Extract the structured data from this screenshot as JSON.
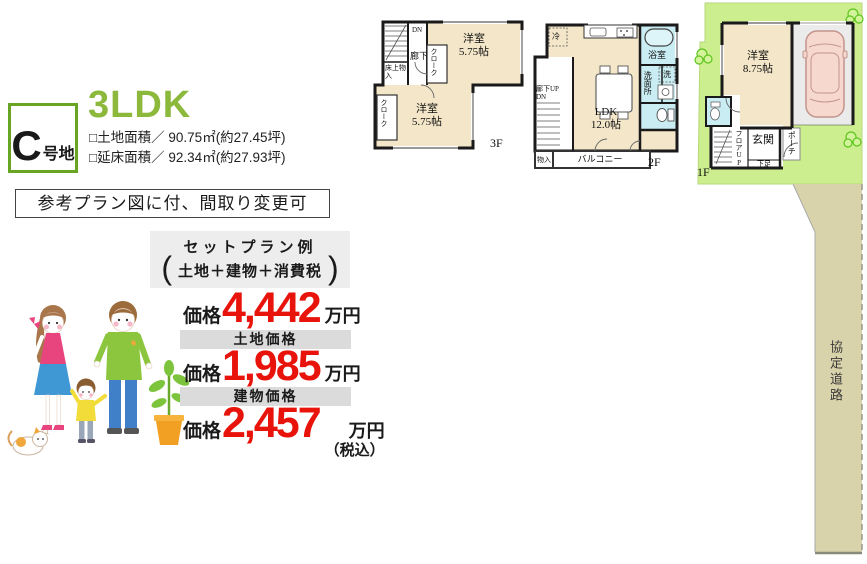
{
  "plot": {
    "letter": "C",
    "suffix": "号地"
  },
  "title": {
    "layout": "3LDK"
  },
  "areas": {
    "land": "□土地面積／ 90.75㎡(約27.45坪)",
    "floor": "□延床面積／ 92.34㎡(約27.93坪)"
  },
  "plan_note": "参考プラン図に付、間取り変更可",
  "set_plan": {
    "title": "セットプラン例",
    "open": "(",
    "content": "土地＋建物＋消費税",
    "close": ")"
  },
  "prices": {
    "total": {
      "label": "価格",
      "value": "4,442",
      "unit": "万円"
    },
    "land_band": "土地価格",
    "land": {
      "label": "価格",
      "value": "1,985",
      "unit": "万円"
    },
    "building_band": "建物価格",
    "building": {
      "label": "価格",
      "value": "2,457",
      "unit": "万円",
      "tax": "（税込）"
    }
  },
  "floorplans": {
    "f3": {
      "label": "3F",
      "room_top": {
        "name": "洋室",
        "size": "5.75帖"
      },
      "room_bottom": {
        "name": "洋室",
        "size": "5.75帖"
      },
      "closet_top": "クローク",
      "closet_bottom": "クローク",
      "hallway": "廊下",
      "stairs_dn": "DN",
      "storage": "床上物入"
    },
    "f2": {
      "label": "2F",
      "ldk": {
        "name": "LDK",
        "size": "12.0帖"
      },
      "bath": "浴室",
      "washer": "洗",
      "washroom": "洗面所",
      "fridge": "冷",
      "stairs": "廊下UP DN",
      "storage": "物入",
      "balcony": "バルコニー"
    },
    "f1": {
      "label": "1F",
      "room": {
        "name": "洋室",
        "size": "8.75帖"
      },
      "entrance": "玄関",
      "shoe_storage": "下足",
      "porch": "ポーチ",
      "stairs": "フロアUP"
    },
    "road": "協定道路"
  },
  "colors": {
    "accent_green": "#8cb93c",
    "border_green": "#67a522",
    "price_red": "#e8130b",
    "room_beige": "#f4e7c9",
    "wet_cyan": "#c9edf2",
    "plot_green": "#cdee8e",
    "road_beige": "#d8d3aa",
    "garage_gray": "#ebebeb",
    "band_gray": "#dbdbdb",
    "box_gray": "#ededed"
  }
}
